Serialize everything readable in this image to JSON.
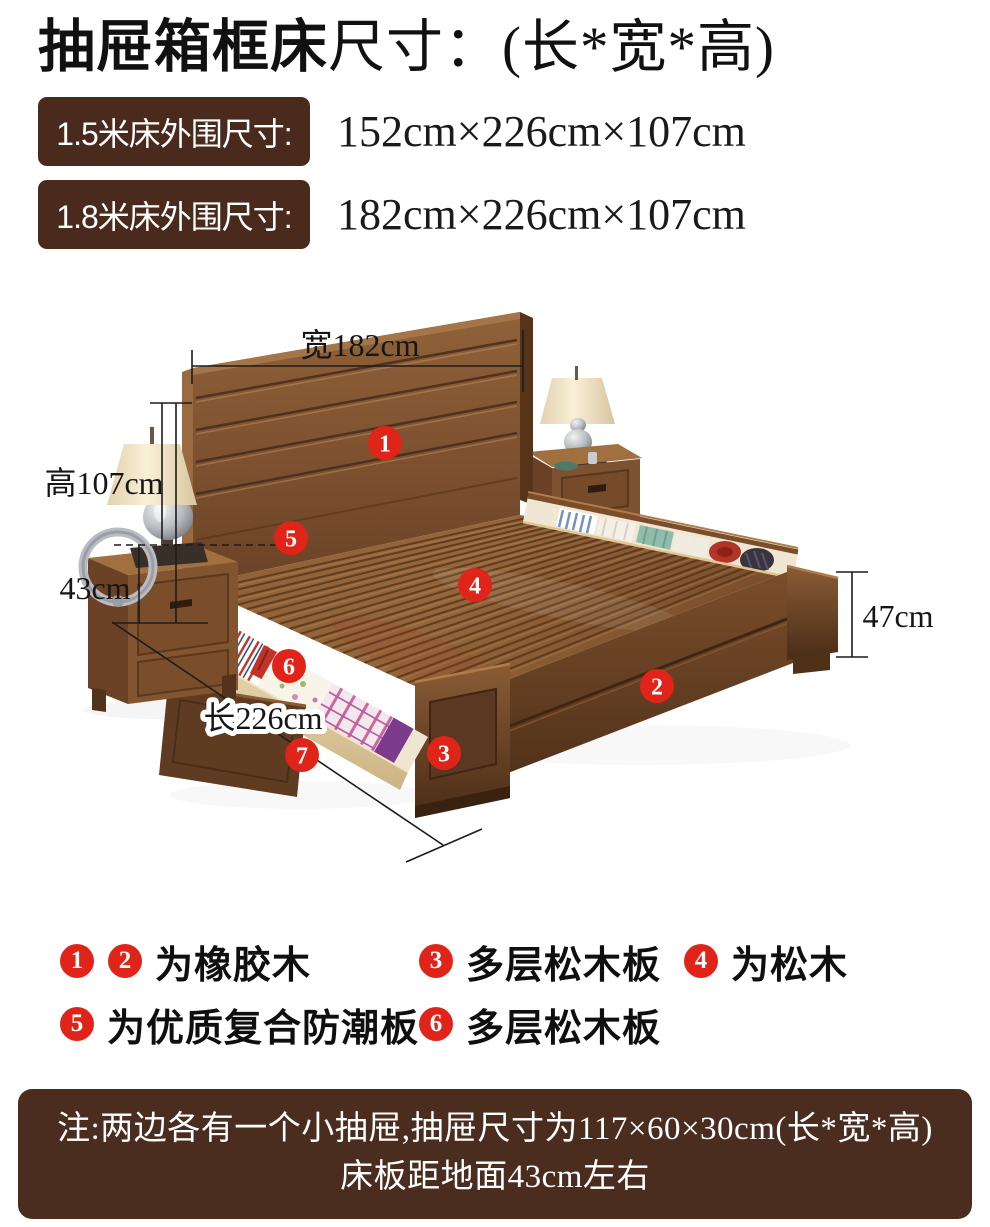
{
  "title": {
    "main": "抽屉箱框床",
    "suffix": "尺寸：(长*宽*高)"
  },
  "size_rows": [
    {
      "label": "1.5米床外围尺寸:",
      "value": "152cm×226cm×107cm"
    },
    {
      "label": "1.8米床外围尺寸:",
      "value": "182cm×226cm×107cm"
    }
  ],
  "diagram": {
    "width_label": "宽182cm",
    "height_label": "高107cm",
    "platform_height_label": "43cm",
    "length_label": "长226cm",
    "footboard_height_label": "47cm",
    "badges": [
      "1",
      "2",
      "3",
      "4",
      "5",
      "6",
      "7"
    ]
  },
  "legend": {
    "items": [
      {
        "badges": [
          "1",
          "2"
        ],
        "label": "为橡胶木"
      },
      {
        "badges": [
          "3"
        ],
        "label": "多层松木板"
      },
      {
        "badges": [
          "4"
        ],
        "label": "为松木"
      },
      {
        "badges": [
          "5"
        ],
        "label": "为优质复合防潮板"
      },
      {
        "badges": [
          "6"
        ],
        "label": "多层松木板"
      }
    ]
  },
  "note": {
    "line1": "注:两边各有一个小抽屉,抽屉尺寸为117×60×30cm(长*宽*高)",
    "line2": "床板距地面43cm左右"
  },
  "colors": {
    "accent_red": "#e02419",
    "label_brown": "#4a2a1c",
    "note_brown": "#4a2d1f",
    "text_dark": "#141414"
  }
}
